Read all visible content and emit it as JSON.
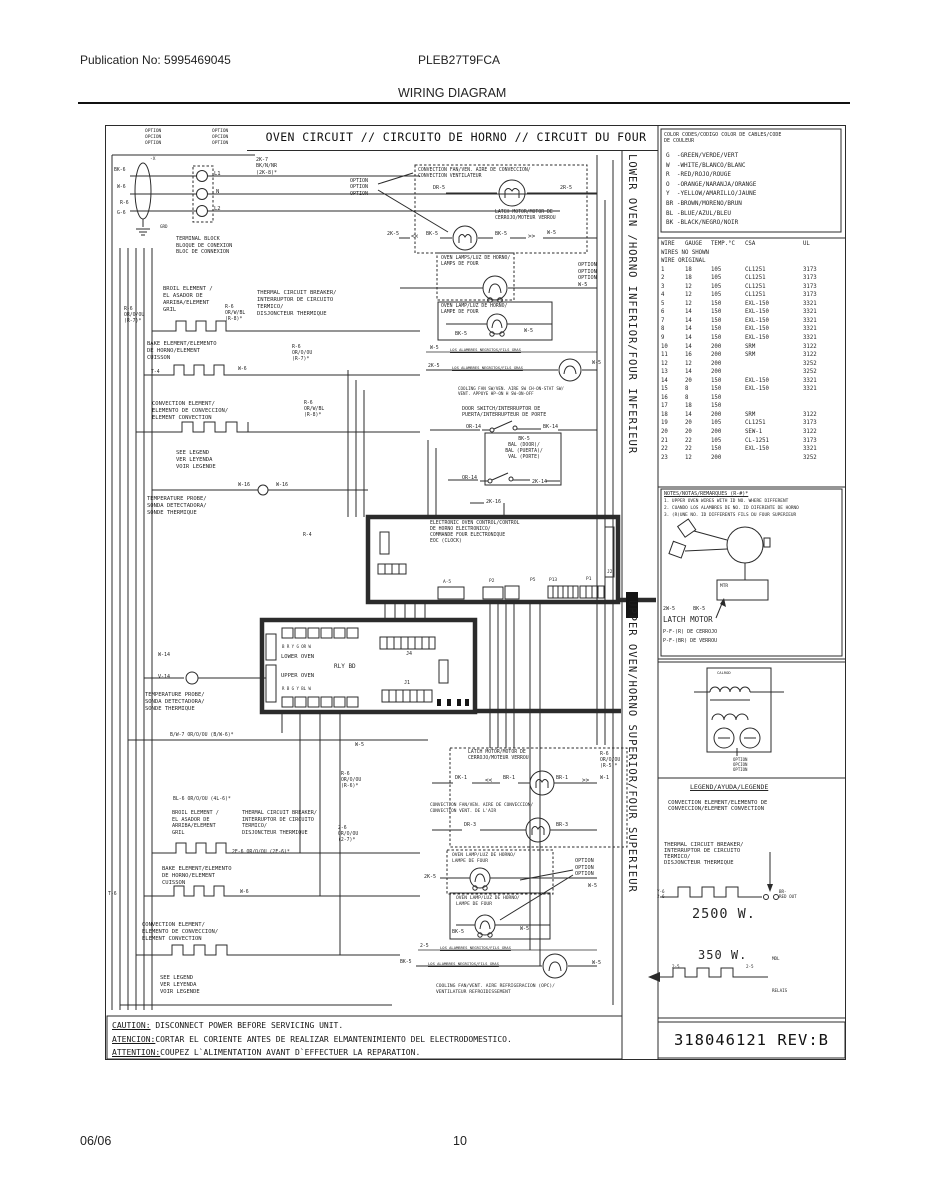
{
  "page": {
    "publication": "Publication No: 5995469045",
    "model": "PLEB27T9FCA",
    "title": "WIRING DIAGRAM",
    "footer_date": "06/06",
    "footer_page": "10"
  },
  "diagram": {
    "title": "OVEN CIRCUIT // CIRCUITO DE HORNO // CIRCUIT DU FOUR",
    "side_lower": "LOWER OVEN /HORNO INFERIOR/FOUR INFERIEUR",
    "side_upper": "UPPER OVEN/HORNO SUPERIOR/FOUR SUPERIEUR",
    "part_number": "318046121 REV:B"
  },
  "caution": {
    "lines": [
      {
        "prefix": "CAUTION:",
        "rest": " DISCONNECT POWER BEFORE SERVICING UNIT."
      },
      {
        "prefix": "ATENCION:",
        "rest": "CORTAR EL CORIENTE ANTES DE REALIZAR ELMANTENIMIENTO DEL ELECTRODOMESTICO."
      },
      {
        "prefix": "ATTENTION:",
        "rest": "COUPEZ L`ALIMENTATION AVANT D`EFFECTUER LA REPARATION."
      }
    ]
  },
  "color_codes": {
    "header": "COLOR CODES/CODIGO COLOR DE CABLES/CODE\nDE COULEUR",
    "entries": [
      "G  -GREEN/VERDE/VERT",
      "W  -WHITE/BLANCO/BLANC",
      "R  -RED/ROJO/ROUGE",
      "O  -ORANGE/NARANJA/ORANGE",
      "Y  -YELLOW/AMARILLO/JAUNE",
      "BR -BROWN/MORENO/BRUN",
      "BL -BLUE/AZUL/BLEU",
      "BK -BLACK/NEGRO/NOIR"
    ]
  },
  "wire_table": {
    "rows": [
      [
        "WIRE",
        "GAUGE",
        "TEMP.°C",
        "CSA",
        "UL"
      ],
      [
        "WIRES NO SHOWN"
      ],
      [
        "WIRE ORIGINAL"
      ],
      [
        "1",
        "18",
        "105",
        "CL1251",
        "3173"
      ],
      [
        "2",
        "18",
        "105",
        "CL1251",
        "3173"
      ],
      [
        "3",
        "12",
        "105",
        "CL1251",
        "3173"
      ],
      [
        "4",
        "12",
        "105",
        "CL1251",
        "3173"
      ],
      [
        "5",
        "12",
        "150",
        "EXL-150",
        "3321"
      ],
      [
        "6",
        "14",
        "150",
        "EXL-150",
        "3321"
      ],
      [
        "7",
        "14",
        "150",
        "EXL-150",
        "3321"
      ],
      [
        "8",
        "14",
        "150",
        "EXL-150",
        "3321"
      ],
      [
        "9",
        "14",
        "150",
        "EXL-150",
        "3321"
      ],
      [
        "10",
        "14",
        "200",
        "SRM",
        "3122"
      ],
      [
        "11",
        "16",
        "200",
        "SRM",
        "3122"
      ],
      [
        "12",
        "12",
        "200",
        "",
        "3252"
      ],
      [
        "13",
        "14",
        "200",
        "",
        "3252"
      ],
      [
        "14",
        "20",
        "150",
        "EXL-150",
        "3321"
      ],
      [
        "15",
        "8",
        "150",
        "EXL-150",
        "3321"
      ],
      [
        "16",
        "8",
        "150",
        "",
        ""
      ],
      [
        "17",
        "18",
        "150",
        "",
        ""
      ],
      [
        "18",
        "14",
        "200",
        "SRM",
        "3122"
      ],
      [
        "19",
        "20",
        "105",
        "CL1251",
        "3173"
      ],
      [
        "20",
        "20",
        "200",
        "SEW-1",
        "3122"
      ],
      [
        "21",
        "22",
        "105",
        "CL-1251",
        "3173"
      ],
      [
        "22",
        "22",
        "150",
        "EXL-150",
        "3321"
      ],
      [
        "23",
        "12",
        "200",
        "",
        "3252"
      ]
    ]
  },
  "notes": {
    "header": "NOTES/NOTAS/REMARQUES (R-#)*",
    "items": [
      "1. UPPER OVEN WIRES WITH ID NO. WHERE DIFFERENT",
      "2. CUANDO LOS ALAMBRES DE NO. ID DIFERENTE DE HORNO",
      "3. (R)UNE NO. ID DIFFERENTS FILS DU FOUR SUPERIEUR"
    ]
  },
  "latch_panel": {
    "wires": "2W-5      BK-5",
    "title": "LATCH MOTOR",
    "line2": "P-F-(R) DE CERROJO",
    "line3": "P-F-(BR) DE VERROU"
  },
  "legend": {
    "header": "LEGEND/AYUDA/LEGENDE",
    "convection": "CONVECTION ELEMENT/ELEMENTO DE\nCONVECCION/ELEMENT CONVECTION",
    "thermal": "THERMAL CIRCUIT BREAKER/\nINTERRUPTOR DE CIRCUITO\nTERMICO/\nDISJONCTEUR THERMIQUE",
    "watts_bake": "2500 W.",
    "watts_conv": "350 W."
  },
  "labels": [
    {
      "n": "option-stack-1",
      "t": "OPTION\nOPCION\nOPTION",
      "x": 145,
      "y": 129,
      "fs": 4.5
    },
    {
      "n": "option-stack-2",
      "t": "OPTION\nOPCION\nOPTION",
      "x": 212,
      "y": 129,
      "fs": 4.5
    },
    {
      "n": "wire-label-2k7",
      "t": "2K-7\nBK/N/NR\n(2K-8)*",
      "x": 256,
      "y": 157,
      "fs": 5
    },
    {
      "n": "terminal-l1",
      "t": "L1",
      "x": 214,
      "y": 171,
      "fs": 5.5
    },
    {
      "n": "terminal-n",
      "t": "N",
      "x": 216,
      "y": 189,
      "fs": 5.5
    },
    {
      "n": "terminal-l2",
      "t": "L2",
      "x": 214,
      "y": 206,
      "fs": 5.5
    },
    {
      "n": "wire-label-x",
      "t": "-X",
      "x": 150,
      "y": 157,
      "fs": 4.5
    },
    {
      "n": "wire-label-bk6",
      "t": "BK-6",
      "x": 114,
      "y": 168,
      "fs": 4.8
    },
    {
      "n": "wire-label-w6",
      "t": "W-6",
      "x": 117,
      "y": 185,
      "fs": 4.8
    },
    {
      "n": "wire-label-r6",
      "t": "R-6",
      "x": 120,
      "y": 201,
      "fs": 4.8
    },
    {
      "n": "wire-label-g6",
      "t": "G-6",
      "x": 117,
      "y": 211,
      "fs": 4.8
    },
    {
      "n": "ground-label",
      "t": "GRD",
      "x": 160,
      "y": 224,
      "fs": 4.2
    },
    {
      "n": "terminal-block-label",
      "t": "TERMINAL BLOCK\nBLOQUE DE CONEXION\nBLOC DE CONNEXION",
      "x": 176,
      "y": 236,
      "fs": 5.2
    },
    {
      "n": "convection-fan-label-1",
      "t": "CONVECTION FAN/VEN. AIRE DE CONVECCION/\nCONVECTION VENTILATEUR",
      "x": 418,
      "y": 168,
      "fs": 4.8
    },
    {
      "n": "option-callout-1",
      "t": "OPTION\nOPTION\nOPTION",
      "x": 350,
      "y": 178,
      "fs": 5
    },
    {
      "n": "wire-label-dr5",
      "t": "DR-5",
      "x": 433,
      "y": 185,
      "fs": 5
    },
    {
      "n": "wire-label-2r5",
      "t": "2R-5",
      "x": 560,
      "y": 185,
      "fs": 5
    },
    {
      "n": "latch-motor-label-1",
      "t": "LATCH MOTOR/MOTOR DE\nCERROJO/MOTEUR VERROU",
      "x": 495,
      "y": 210,
      "fs": 4.8
    },
    {
      "n": "wire-label-2k5-a",
      "t": "2K-5",
      "x": 387,
      "y": 231,
      "fs": 5
    },
    {
      "n": "chevron-left-1",
      "t": "<<",
      "x": 411,
      "y": 233,
      "fs": 6
    },
    {
      "n": "wire-label-bk5-a",
      "t": "BK-5",
      "x": 426,
      "y": 231,
      "fs": 5
    },
    {
      "n": "wire-label-bk5-b",
      "t": "BK-5",
      "x": 495,
      "y": 231,
      "fs": 5
    },
    {
      "n": "chevron-right-1",
      "t": ">>",
      "x": 528,
      "y": 233,
      "fs": 6
    },
    {
      "n": "wire-label-w5-a",
      "t": "W-5",
      "x": 547,
      "y": 230,
      "fs": 5
    },
    {
      "n": "oven-lamps-label",
      "t": "OVEN LAMPS/LUZ DE HORNO/\nLAMPS DE FOUR",
      "x": 441,
      "y": 256,
      "fs": 4.8
    },
    {
      "n": "option-callout-2",
      "t": "OPTION\nOPTION\nOPTION\nW-5",
      "x": 578,
      "y": 262,
      "fs": 5.2
    },
    {
      "n": "oven-lamp-label-1",
      "t": "OVEN LAMP/LUZ DE HORNO/\nLAMPE DE FOUR",
      "x": 441,
      "y": 304,
      "fs": 4.8
    },
    {
      "n": "wire-label-bk5-c",
      "t": "BK-5",
      "x": 455,
      "y": 331,
      "fs": 5
    },
    {
      "n": "wire-label-w5-b",
      "t": "W-5",
      "x": 524,
      "y": 328,
      "fs": 5
    },
    {
      "n": "ribbon-wire-1",
      "t": "W-5",
      "x": 430,
      "y": 346,
      "fs": 4.8
    },
    {
      "n": "ribbon-note-1",
      "t": "LOS ALAMBRES NEGRITOS/FILS GRAS",
      "x": 450,
      "y": 348,
      "fs": 3.8,
      "u": 1
    },
    {
      "n": "ribbon-wire-2",
      "t": "2K-5",
      "x": 428,
      "y": 364,
      "fs": 4.8
    },
    {
      "n": "ribbon-note-2",
      "t": "LOS ALAMBRES NEGRITOS/FILS GRAS",
      "x": 452,
      "y": 366,
      "fs": 3.8,
      "u": 1
    },
    {
      "n": "wire-label-w5-c",
      "t": "W-5",
      "x": 592,
      "y": 360,
      "fs": 5
    },
    {
      "n": "cooling-fan-sw-label",
      "t": "COOLING FAN SW/VEN. AIRE SW CH-ON-STAT SW/\nVENT. APPUYE HP-ON H SW-ON-OFF",
      "x": 458,
      "y": 386,
      "fs": 4.2
    },
    {
      "n": "door-switch-label-1",
      "t": "DOOR SWITCH/INTERRUPTOR DE\nPUERTA/INTERRUPTEUR DE PORTE",
      "x": 462,
      "y": 406,
      "fs": 5
    },
    {
      "n": "wire-label-or14-a",
      "t": "OR-14",
      "x": 466,
      "y": 424,
      "fs": 5
    },
    {
      "n": "wire-label-bk14",
      "t": "BK-14",
      "x": 543,
      "y": 424,
      "fs": 5
    },
    {
      "n": "door-box-label",
      "t": "BK-5\nBAL (DOOR)/\nBAL (PUERTA)/\nVAL (PORTE)",
      "x": 487,
      "y": 437,
      "fs": 4.8,
      "w": 74,
      "ta": "center"
    },
    {
      "n": "wire-label-or14-b",
      "t": "OR-14",
      "x": 462,
      "y": 475,
      "fs": 5
    },
    {
      "n": "wire-label-2k14",
      "t": "2K-14",
      "x": 532,
      "y": 479,
      "fs": 5
    },
    {
      "n": "wire-label-2k16",
      "t": "2K-16",
      "x": 486,
      "y": 499,
      "fs": 5
    },
    {
      "n": "wire-label-w16-a",
      "t": "W-16",
      "x": 238,
      "y": 482,
      "fs": 5
    },
    {
      "n": "wire-label-w16-b",
      "t": "W-16",
      "x": 276,
      "y": 482,
      "fs": 5
    },
    {
      "n": "probe-label-1",
      "t": "TEMPERATURE PROBE/\nSONDA DETECTADORA/\nSONDE THERMIQUE",
      "x": 147,
      "y": 496,
      "fs": 5.5
    },
    {
      "n": "broil-element-label-1",
      "t": "BROIL ELEMENT /\nEL ASADOR DE\nARRIBA/ELEMENT\nGRIL",
      "x": 163,
      "y": 286,
      "fs": 5.5
    },
    {
      "n": "wire-label-r6-a",
      "t": "R-6\nOR/O/OU\n(R-7)*",
      "x": 124,
      "y": 307,
      "fs": 4.8
    },
    {
      "n": "wire-label-r6-b",
      "t": "R-6\nOR/W/BL\n(R-8)*",
      "x": 225,
      "y": 305,
      "fs": 4.8
    },
    {
      "n": "thermal-breaker-label-1",
      "t": "THERMAL CIRCUIT BREAKER/\nINTERRUPTOR DE CIRCUITO\nTERMICO/\nDISJONCTEUR THERMIQUE",
      "x": 257,
      "y": 290,
      "fs": 5.5
    },
    {
      "n": "wire-label-r6-c",
      "t": "R-6\nOR/O/OU\n(R-7)*",
      "x": 292,
      "y": 345,
      "fs": 4.8
    },
    {
      "n": "bake-element-label-1",
      "t": "BAKE ELEMENT/ELEMENTO\nDE HORNO/ELEMENT\nCUISSON",
      "x": 147,
      "y": 341,
      "fs": 5.5
    },
    {
      "n": "wire-label-t4",
      "t": "T-4",
      "x": 151,
      "y": 370,
      "fs": 4.8
    },
    {
      "n": "wire-label-w6-a",
      "t": "W-6",
      "x": 238,
      "y": 367,
      "fs": 4.8
    },
    {
      "n": "convection-element-label-1",
      "t": "CONVECTION ELEMENT/\nELEMENTO DE CONVECCION/\nELEMENT CONVECTION",
      "x": 152,
      "y": 401,
      "fs": 5.5
    },
    {
      "n": "wire-label-r6-d",
      "t": "R-6\nOR/W/BL\n(R-8)*",
      "x": 304,
      "y": 401,
      "fs": 4.8
    },
    {
      "n": "see-legend-label-1",
      "t": "SEE LEGEND\nVER LEYENDA\nVOIR LEGENDE",
      "x": 176,
      "y": 450,
      "fs": 5.5
    },
    {
      "n": "wire-label-r4",
      "t": "R-4",
      "x": 303,
      "y": 533,
      "fs": 4.8
    },
    {
      "n": "eoc-label",
      "t": "ELECTRONIC OVEN CONTROL/CONTROL\nDE HORNO ELECTRONICO/\nCOMMANDE FOUR ELECTRONIQUE\nEOC (CLOCK)",
      "x": 430,
      "y": 521,
      "fs": 4.8
    },
    {
      "n": "connector-label-a5",
      "t": "A-5",
      "x": 443,
      "y": 580,
      "fs": 4.5
    },
    {
      "n": "connector-label-p2",
      "t": "P2",
      "x": 489,
      "y": 579,
      "fs": 4.5
    },
    {
      "n": "connector-label-p5",
      "t": "P5",
      "x": 530,
      "y": 578,
      "fs": 4.5
    },
    {
      "n": "connector-label-p13",
      "t": "P13",
      "x": 549,
      "y": 578,
      "fs": 4.5
    },
    {
      "n": "connector-label-p1",
      "t": "P1",
      "x": 586,
      "y": 577,
      "fs": 4.5
    },
    {
      "n": "connector-label-j2",
      "t": "J2",
      "x": 607,
      "y": 570,
      "fs": 4.5
    },
    {
      "n": "relay-letters-top",
      "t": "B R Y G OR W",
      "x": 282,
      "y": 644,
      "fs": 4
    },
    {
      "n": "lower-oven-relay-label",
      "t": "LOWER OVEN",
      "x": 281,
      "y": 654,
      "fs": 5.5
    },
    {
      "n": "relay-board-label",
      "t": "RLY BD",
      "x": 334,
      "y": 663,
      "fs": 6
    },
    {
      "n": "upper-oven-relay-label",
      "t": "UPPER OVEN",
      "x": 281,
      "y": 673,
      "fs": 5.5
    },
    {
      "n": "relay-letters-bottom",
      "t": "R B G Y BL W",
      "x": 282,
      "y": 686,
      "fs": 4
    },
    {
      "n": "connector-label-j4",
      "t": "J4",
      "x": 406,
      "y": 651,
      "fs": 5
    },
    {
      "n": "connector-label-j1",
      "t": "J1",
      "x": 404,
      "y": 680,
      "fs": 5
    },
    {
      "n": "wire-label-w14",
      "t": "W-14",
      "x": 158,
      "y": 652,
      "fs": 5
    },
    {
      "n": "wire-label-v14",
      "t": "V-14",
      "x": 158,
      "y": 674,
      "fs": 5
    },
    {
      "n": "probe-label-2",
      "t": "TEMPERATURE PROBE/\nSONDA DETECTADORA/\nSONDE THERMIQUE",
      "x": 145,
      "y": 692,
      "fs": 5.5
    },
    {
      "n": "wire-label-bw7",
      "t": "B/W-7 OR/O/OU (B/W-6)*",
      "x": 170,
      "y": 733,
      "fs": 4.8
    },
    {
      "n": "wire-label-w5-d",
      "t": "W-5",
      "x": 355,
      "y": 742,
      "fs": 5
    },
    {
      "n": "wire-label-r6-e",
      "t": "R-6\nOR/O/OU\n(R-6)*",
      "x": 341,
      "y": 772,
      "fs": 4.8
    },
    {
      "n": "wire-label-r6-f",
      "t": "R-6\nOR/O/OU\n(R-5)*",
      "x": 600,
      "y": 752,
      "fs": 4.8
    },
    {
      "n": "wire-label-bl6",
      "t": "BL-6 OR/O/OU (4L-6)*",
      "x": 173,
      "y": 797,
      "fs": 4.8
    },
    {
      "n": "broil-element-label-2",
      "t": "BROIL ELEMENT /\nEL ASADOR DE\nARRIBA/ELEMENT\nGRIL",
      "x": 172,
      "y": 810,
      "fs": 5.2
    },
    {
      "n": "thermal-breaker-label-2",
      "t": "THERMAL CIRCUIT BREAKER/\nINTERRUPTOR DE CIRCUITO\nTERMICO/\nDISJONCTEUR THERMIQUE",
      "x": 242,
      "y": 810,
      "fs": 5.2
    },
    {
      "n": "wire-label-2e6",
      "t": "2E-6 OR/O/OU (2E-6)*",
      "x": 232,
      "y": 850,
      "fs": 4.8
    },
    {
      "n": "wire-label-26",
      "t": "2-6\nOR/O/OU\n(2-7)*",
      "x": 338,
      "y": 826,
      "fs": 4.8
    },
    {
      "n": "bake-element-label-2",
      "t": "BAKE ELEMENT/ELEMENTO\nDE HORNO/ELEMENT\nCUISSON",
      "x": 162,
      "y": 866,
      "fs": 5.5
    },
    {
      "n": "wire-label-t6",
      "t": "T-6",
      "x": 108,
      "y": 892,
      "fs": 4.8
    },
    {
      "n": "wire-label-w6-b",
      "t": "W-6",
      "x": 240,
      "y": 890,
      "fs": 4.8
    },
    {
      "n": "convection-element-label-2",
      "t": "CONVECTION ELEMENT/\nELEMENTO DE CONVECCION/\nELEMENT CONVECTION",
      "x": 142,
      "y": 922,
      "fs": 5.5
    },
    {
      "n": "see-legend-label-2",
      "t": "SEE LEGEND\nVER LEYENDA\nVOIR LEGENDE",
      "x": 160,
      "y": 975,
      "fs": 5.5
    },
    {
      "n": "latch-motor-label-2",
      "t": "LATCH MOTOR/MOTOR DE\nCERROJO/MOTEUR VERROU",
      "x": 468,
      "y": 750,
      "fs": 4.8
    },
    {
      "n": "wire-label-dk1",
      "t": "DK-1",
      "x": 455,
      "y": 775,
      "fs": 5
    },
    {
      "n": "chevron-left-2",
      "t": "<<",
      "x": 485,
      "y": 777,
      "fs": 6
    },
    {
      "n": "wire-label-br1-a",
      "t": "BR-1",
      "x": 503,
      "y": 775,
      "fs": 5
    },
    {
      "n": "wire-label-br1-b",
      "t": "BR-1",
      "x": 556,
      "y": 775,
      "fs": 5
    },
    {
      "n": "chevron-right-2",
      "t": ">>",
      "x": 582,
      "y": 777,
      "fs": 6
    },
    {
      "n": "wire-label-w1",
      "t": "W-1",
      "x": 600,
      "y": 775,
      "fs": 5
    },
    {
      "n": "convection-fan-label-2",
      "t": "CONVECTION FAN/VEN. AIRE DE CONVECCION/\nCONVECTION VENT. DE L'AIR",
      "x": 430,
      "y": 803,
      "fs": 4.4
    },
    {
      "n": "wire-label-dr3",
      "t": "DR-3",
      "x": 464,
      "y": 822,
      "fs": 5
    },
    {
      "n": "wire-label-br3",
      "t": "BR-3",
      "x": 556,
      "y": 822,
      "fs": 5
    },
    {
      "n": "oven-lamp-label-2",
      "t": "OVEN LAMP/LUZ DE HORNO/\nLAMPE DE FOUR",
      "x": 452,
      "y": 853,
      "fs": 4.6
    },
    {
      "n": "option-callout-3",
      "t": "OPTION\nOPTION\nOPTION",
      "x": 575,
      "y": 858,
      "fs": 5.2
    },
    {
      "n": "wire-label-2k5-b",
      "t": "2K-5",
      "x": 424,
      "y": 874,
      "fs": 5
    },
    {
      "n": "wire-label-w5-e",
      "t": "W-5",
      "x": 588,
      "y": 883,
      "fs": 5
    },
    {
      "n": "oven-lamp-label-3",
      "t": "OVEN LAMP/LUZ DE HORNO/\nLAMPE DE FOUR",
      "x": 456,
      "y": 896,
      "fs": 4.6
    },
    {
      "n": "wire-label-bk5-d",
      "t": "BK-5",
      "x": 452,
      "y": 929,
      "fs": 5
    },
    {
      "n": "wire-label-w5-f",
      "t": "W-5",
      "x": 520,
      "y": 926,
      "fs": 5
    },
    {
      "n": "ribbon-wire-3",
      "t": "2-5",
      "x": 420,
      "y": 944,
      "fs": 4.8
    },
    {
      "n": "ribbon-note-3",
      "t": "LOS ALAMBRES NEGRITOS/FILS GRAS",
      "x": 440,
      "y": 946,
      "fs": 3.8,
      "u": 1
    },
    {
      "n": "ribbon-wire-4",
      "t": "BK-5",
      "x": 400,
      "y": 960,
      "fs": 4.8
    },
    {
      "n": "ribbon-note-4",
      "t": "LOS ALAMBRES NEGRITOS/FILS GRAS",
      "x": 428,
      "y": 962,
      "fs": 3.8,
      "u": 1
    },
    {
      "n": "wire-label-w5-g",
      "t": "W-5",
      "x": 592,
      "y": 960,
      "fs": 5
    },
    {
      "n": "cooling-fan-label",
      "t": "COOLING FAN/VENT. AIRE REFRIGERACION (OPC)/\nVENTILATEUR REFROIDISSEMENT",
      "x": 436,
      "y": 984,
      "fs": 4.6
    },
    {
      "n": "mtr-label",
      "t": "MTR",
      "x": 720,
      "y": 584,
      "fs": 4.5
    },
    {
      "n": "legend-figure-caption",
      "t": "CALROD",
      "x": 717,
      "y": 671,
      "fs": 3.8
    },
    {
      "n": "legend-option-caption",
      "t": "OPTION\nOPCION\nOPTION",
      "x": 733,
      "y": 757,
      "fs": 4
    },
    {
      "n": "wire-label-y6",
      "t": "Y-6\n2-6",
      "x": 657,
      "y": 889,
      "fs": 4.2
    },
    {
      "n": "red-out-label",
      "t": "BR-\nRED OUT",
      "x": 779,
      "y": 889,
      "fs": 4.2
    },
    {
      "n": "wire-label-25-a",
      "t": "2-5",
      "x": 672,
      "y": 964,
      "fs": 4.2
    },
    {
      "n": "wire-label-25-b",
      "t": "2-5",
      "x": 746,
      "y": 964,
      "fs": 4.2
    },
    {
      "n": "mdl-label",
      "t": "MDL",
      "x": 772,
      "y": 956,
      "fs": 4.2
    },
    {
      "n": "relais-label",
      "t": "RELAIS",
      "x": 772,
      "y": 988,
      "fs": 4.2
    }
  ]
}
